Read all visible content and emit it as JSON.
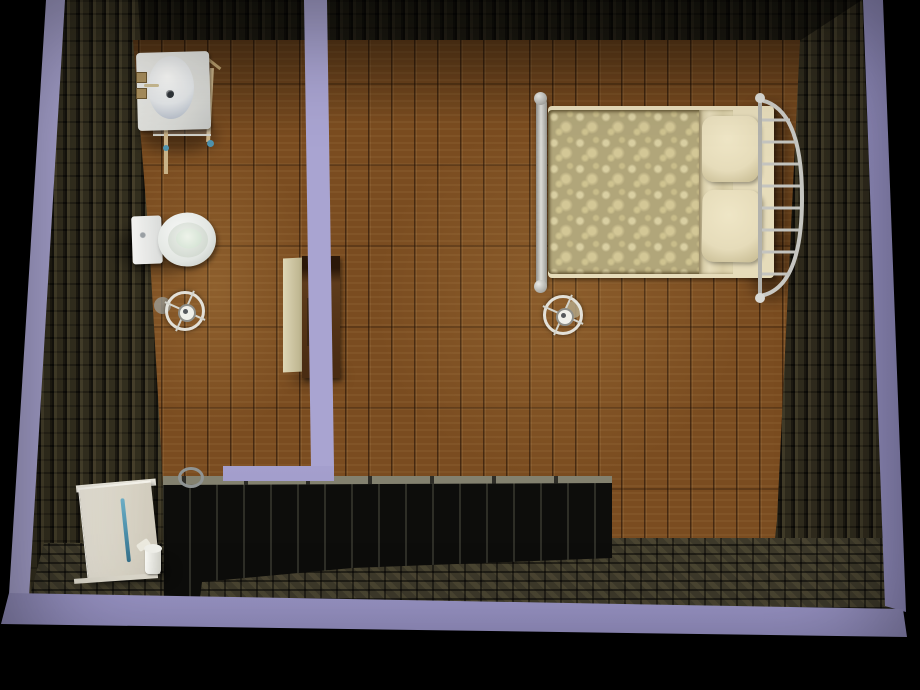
{
  "scene": {
    "description": "Top-down cutaway dollhouse view of two rooms (bathroom and bedroom) with brown plank wood floors, dark stone outer walls shown with lavender cut tops, dark panel south wall, cobblestone ground strip, and furniture",
    "rooms": [
      {
        "id": "bathroom",
        "label": "Bathroom",
        "floor": "brown wood planks"
      },
      {
        "id": "bedroom",
        "label": "Bedroom",
        "floor": "brown wood planks"
      }
    ],
    "objects": {
      "sink": "White pedestal sink table with oval basin, drain and brass faucet",
      "toilet": "White toilet: tank with silver button, oval bowl with pale green water",
      "dresser": "Wood dresser with cream top edge and inset panel, against divider wall",
      "bathroom_lamp": "Round ceiling lamp fixture with crossed spokes",
      "bedroom_lamp": "Round ceiling lamp fixture with crossed spokes",
      "bed": "Double bed: olive floral damask blanket, folded cream sheet, two cream pillows, silver metal footboard and curved rung headboard",
      "door": "Open white door leaf with teal handle bar, white header and rail",
      "cup": "Small white cup/bin beside door",
      "scoop": "Small white tilted lid",
      "latch_ring": "Silver ring latch on dark panel wall"
    },
    "structure": {
      "outer_walls": "dark olive stone brick faces",
      "wall_cut_tops": "lavender cutaway wall tops (left, right, bottom, divider, bathroom south)",
      "south_wall": "near-black vertical wood panels with grey cap segments",
      "ground": "dark cobblestone strip along bottom",
      "background": "black void"
    },
    "palette": {
      "wall_cut": "#a9a4d1",
      "wall_cut_dark": "#8f8abc",
      "brick_base": "#2e2a1c",
      "wood_base": "#7a4c20",
      "cobble_base": "#3d392a",
      "panel_dark": "#0d0d0b",
      "panel_cap": "#83816f",
      "porcelain": "#eef0ef",
      "metal": "#c9c9c4",
      "linen": "#e6dcba",
      "blanket_base": "#b1a67a",
      "blanket_motif": "#d9cfa2",
      "dresser_front": "#5e3b1b",
      "door_face": "#e2ded1",
      "handle_blue": "#4f93ae",
      "water": "#cfe0d0",
      "background": "#000000"
    }
  }
}
